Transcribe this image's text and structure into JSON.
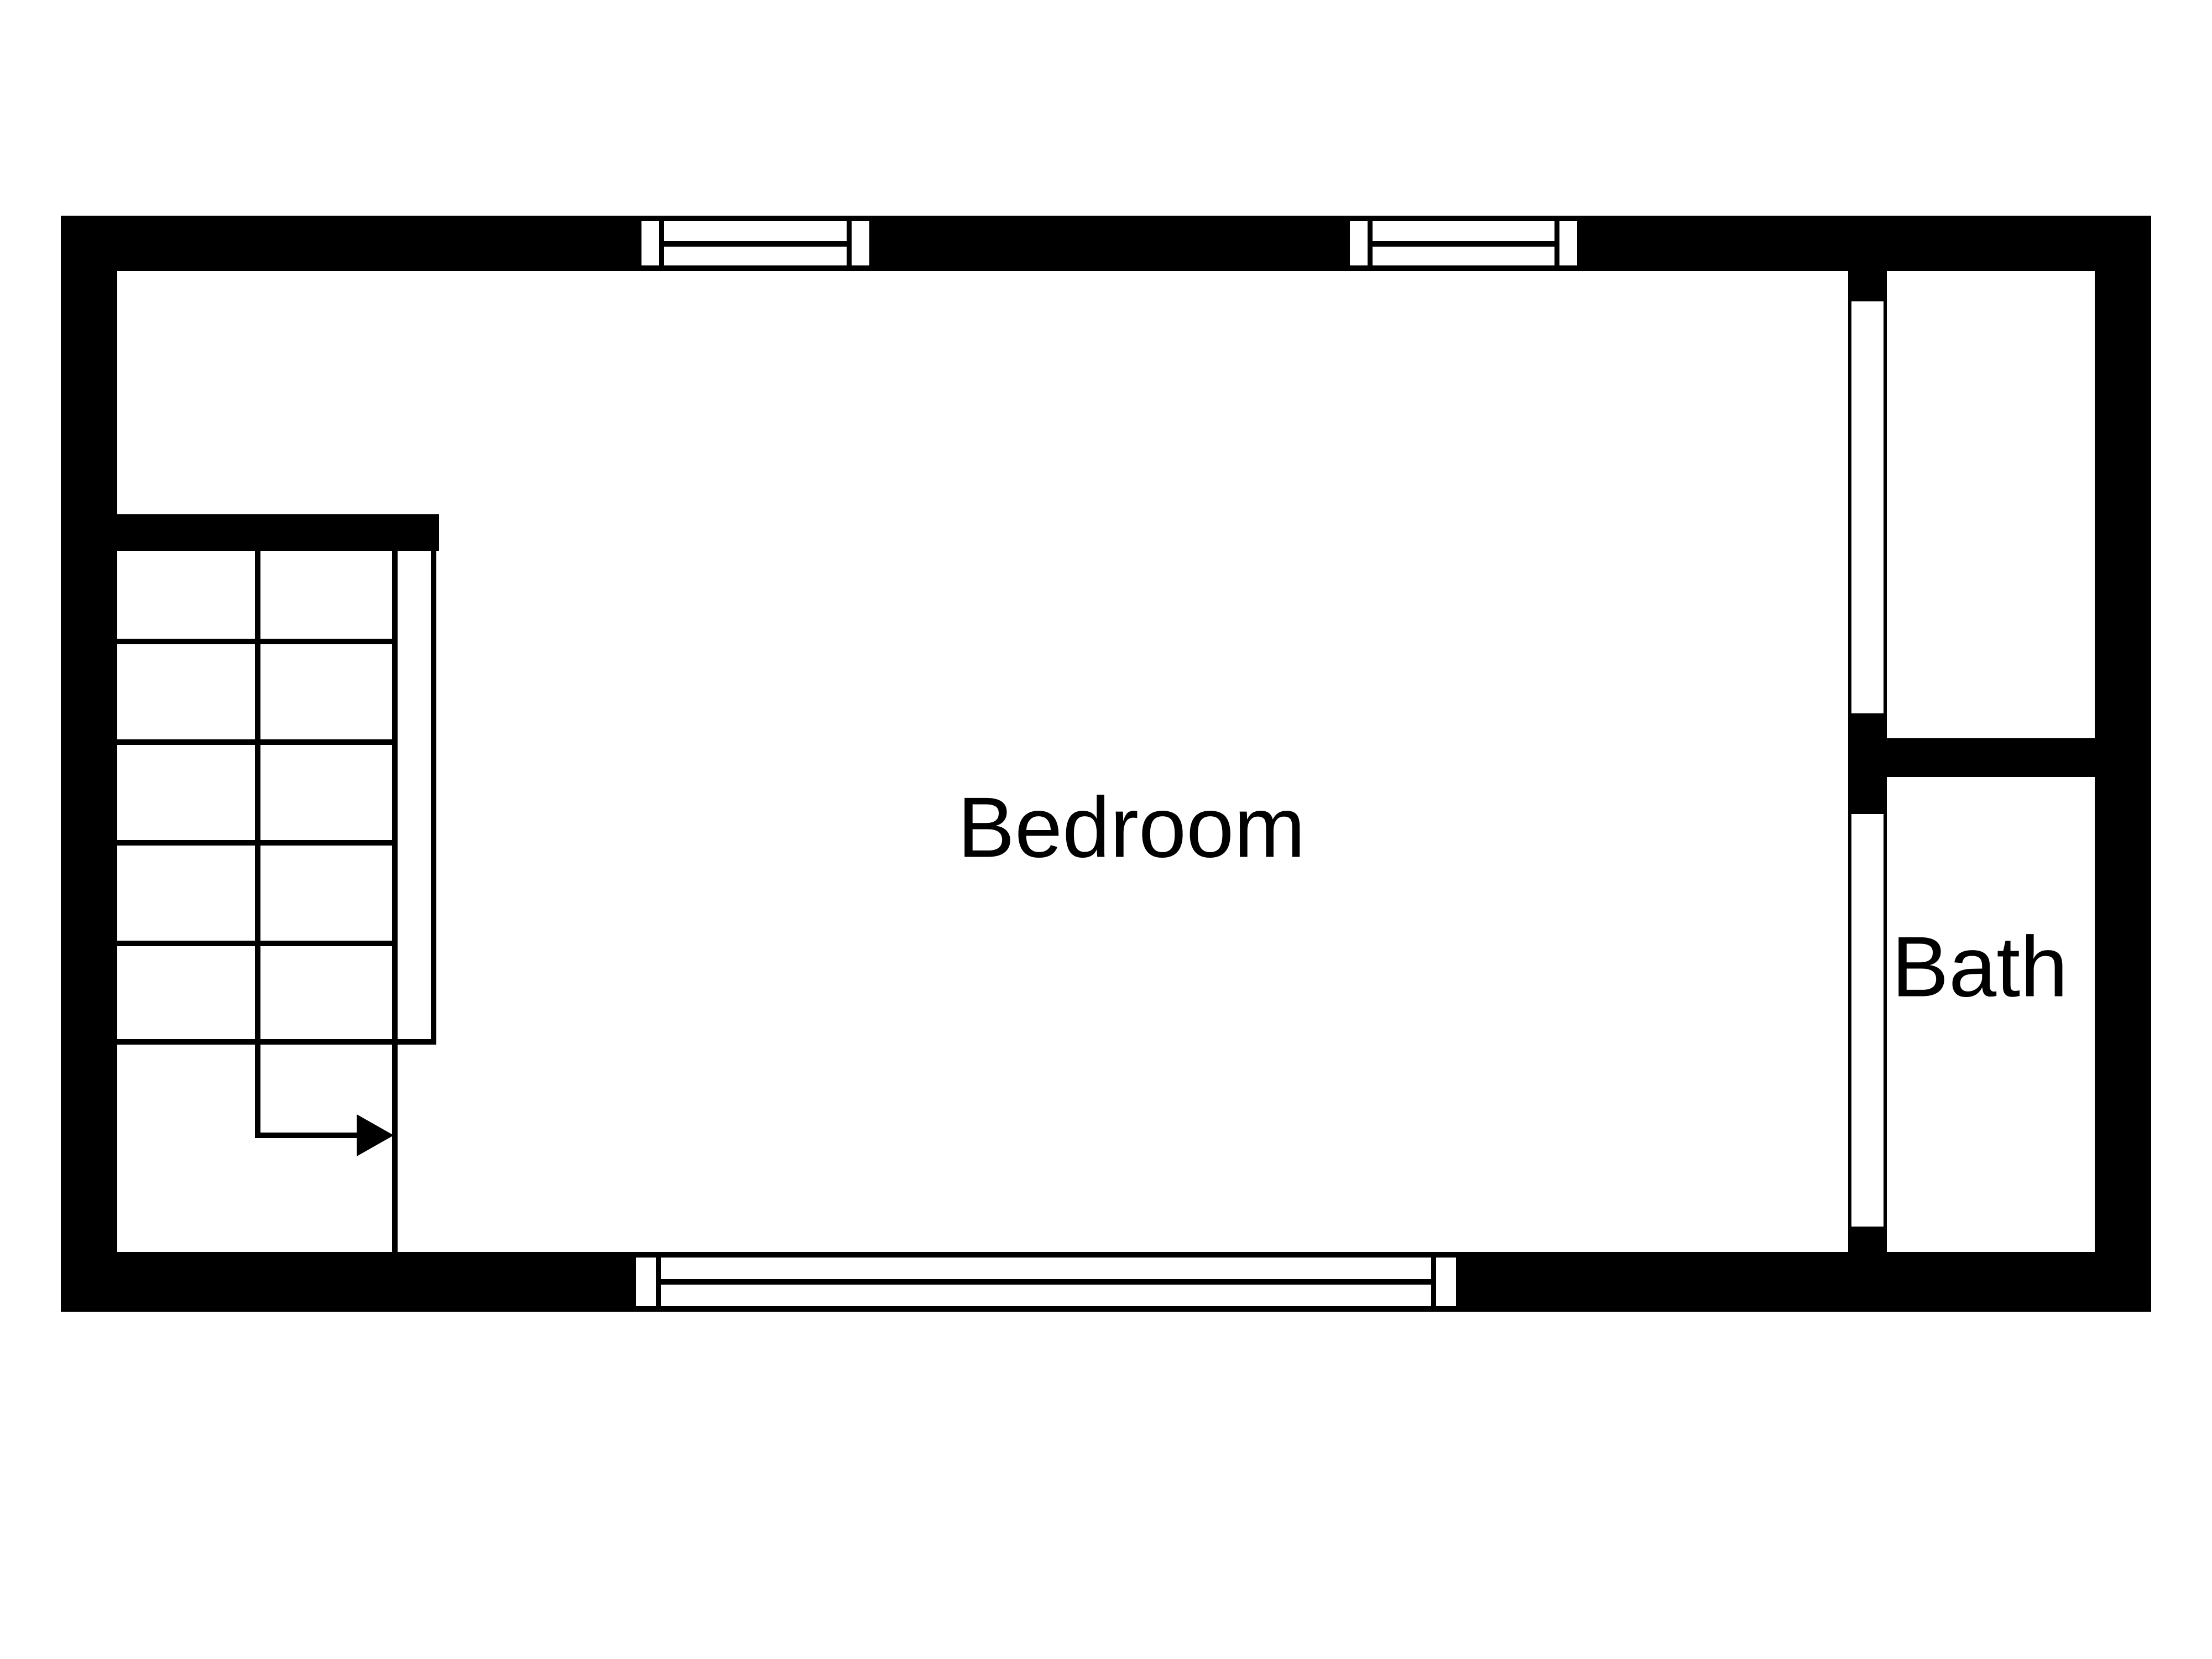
{
  "colors": {
    "background": "#ffffff",
    "wall": "#000000",
    "text": "#000000"
  },
  "rooms": [
    {
      "id": "bedroom",
      "label": "Bedroom"
    },
    {
      "id": "bath",
      "label": "Bath"
    }
  ],
  "stairs": {
    "arrow_direction": "right"
  }
}
